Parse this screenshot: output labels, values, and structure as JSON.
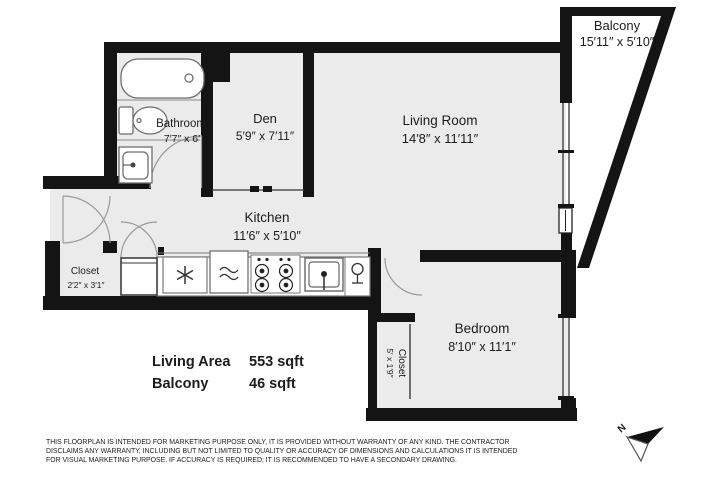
{
  "page": {
    "background": "#ffffff",
    "floor_color": "#ebebeb",
    "wall_color": "#141414",
    "text_color": "#1c1c1c"
  },
  "rooms": {
    "balcony": {
      "name": "Balcony",
      "dims": "15′11″ x 5′10″"
    },
    "bathroom": {
      "name": "Bathroom",
      "dims": "7′7″ x 6′"
    },
    "den": {
      "name": "Den",
      "dims": "5′9″ x 7′11″"
    },
    "living_room": {
      "name": "Living Room",
      "dims": "14′8″ x 11′11″"
    },
    "kitchen": {
      "name": "Kitchen",
      "dims": "11′6″ x 5′10″"
    },
    "entry_closet": {
      "name": "Closet",
      "dims": "2′2″ x 3′1″"
    },
    "bedroom": {
      "name": "Bedroom",
      "dims": "8′10″ x 11′1″"
    },
    "bedroom_closet": {
      "name": "Closet",
      "dims": "5′ x 1′9″"
    }
  },
  "area_summary": {
    "rows": [
      {
        "label": "Living Area",
        "value": "553 sqft"
      },
      {
        "label": "Balcony",
        "value": "46 sqft"
      }
    ]
  },
  "disclaimer": {
    "line1": "THIS FLOORPLAN IS INTENDED FOR MARKETING PURPOSE ONLY, IT IS PROVIDED WITHOUT WARRANTY OF ANY KIND. THE CONTRACTOR",
    "line2": "DISCLAIMS ANY WARRANTY, INCLUDING BUT NOT LIMITED TO QUALITY OR ACCURACY OF DIMENSIONS AND CALCULATIONS IT IS INTENDED",
    "line3": "FOR VISUAL MARKETING PURPOSE. IF ACCURACY IS REQUIRED; IT IS RECOMMENDED TO HAVE A SECONDARY DRAWING."
  },
  "compass": {
    "north_label": "N"
  }
}
